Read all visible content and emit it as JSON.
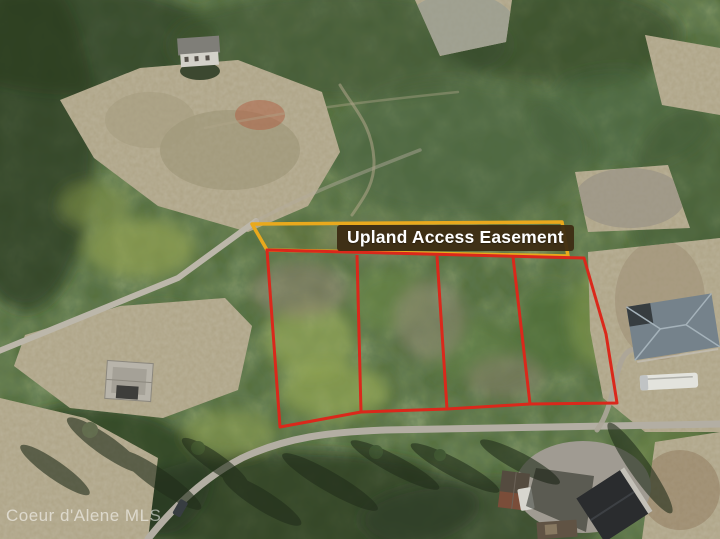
{
  "photo": {
    "kind": "aerial-drone-photo",
    "scene": "Forested hillside with four outlined vacant lots along a road, cleared areas and neighboring houses"
  },
  "overlay": {
    "easement_label": "Upland Access Easement",
    "lot_count": "4",
    "colors": {
      "lot_line": "#da281b",
      "easement_line": "#e9a91d",
      "label_bg": "#3d2c13",
      "label_text": "#ffffff"
    }
  },
  "watermark": {
    "text": "Coeur d'Alene MLS"
  }
}
